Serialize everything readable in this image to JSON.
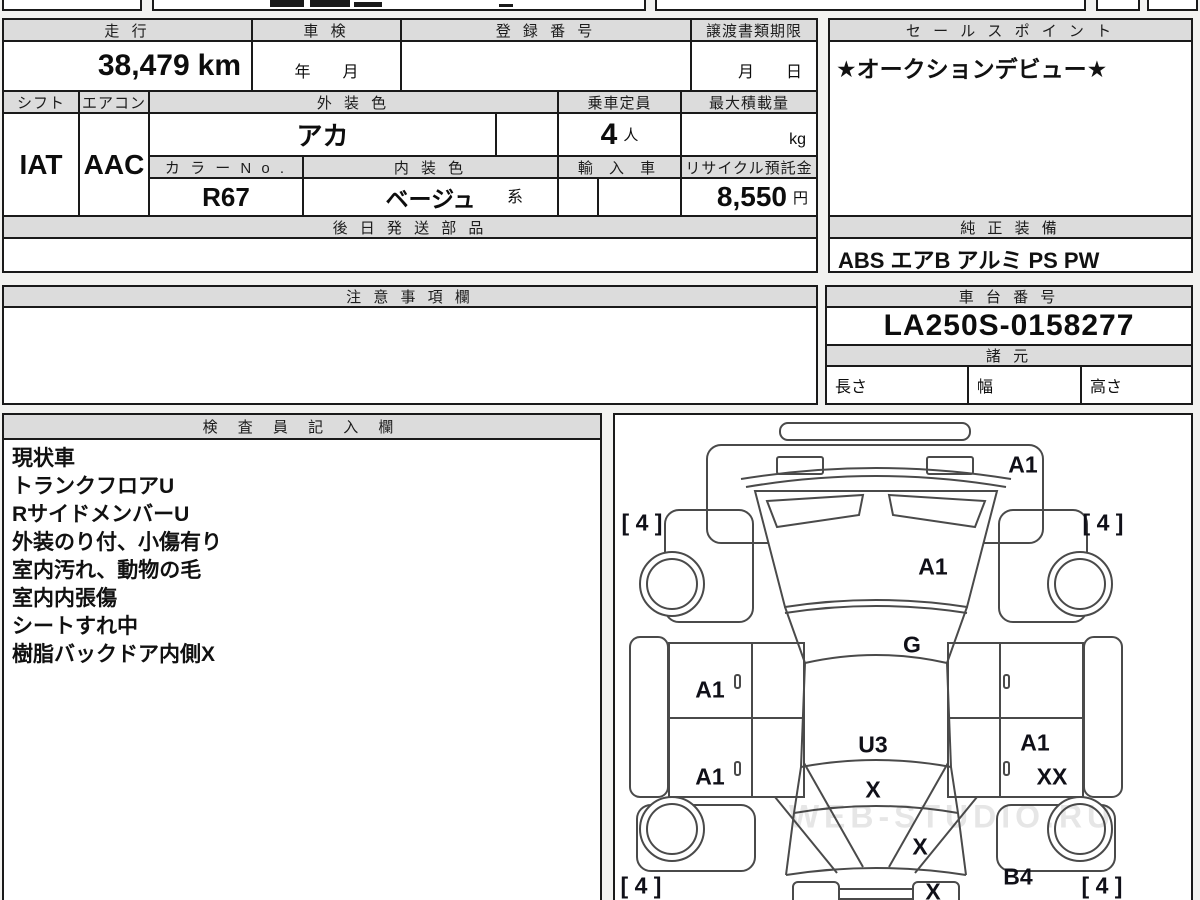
{
  "table": {
    "mileage": {
      "label": "走 行",
      "value": "38,479",
      "unit": "km"
    },
    "inspection": {
      "label": "車 検",
      "value": "年　　月"
    },
    "registration": {
      "label": "登 録 番 号",
      "value": ""
    },
    "transfer_deadline": {
      "label": "譲渡書類期限",
      "value": "月　　日"
    },
    "sales_point": {
      "label": "セ ー ル ス ポ イ ン ト",
      "value": "★オークションデビュー★"
    },
    "shift": {
      "label": "シフト",
      "value": "IAT"
    },
    "aircon": {
      "label": "エアコン",
      "value": "AAC"
    },
    "exterior_color": {
      "label": "外 装 色",
      "value": "アカ"
    },
    "capacity": {
      "label": "乗車定員",
      "value": "4",
      "unit": "人"
    },
    "max_load": {
      "label": "最大積載量",
      "unit": "kg"
    },
    "color_no": {
      "label": "カ ラ ー N o .",
      "value": "R67"
    },
    "interior_color": {
      "label": "内 装 色",
      "value": "ベージュ",
      "suffix": "系"
    },
    "import": {
      "label": "輸 入 車",
      "value": ""
    },
    "recycle_deposit": {
      "label": "リサイクル預託金",
      "value": "8,550",
      "unit": "円"
    },
    "later_parts": {
      "label": "後 日 発 送 部 品",
      "value": ""
    },
    "genuine_equipment": {
      "label": "純 正 装 備",
      "value": "ABS エアB アルミ PS PW"
    }
  },
  "notes": {
    "label": "注 意 事 項 欄",
    "value": ""
  },
  "chassis": {
    "label": "車 台 番 号",
    "value": "LA250S-0158277",
    "spec_label": "諸 元",
    "length_label": "長さ",
    "width_label": "幅",
    "height_label": "高さ"
  },
  "inspector": {
    "label": "検 査 員 記 入 欄",
    "lines": [
      "現状車",
      "トランクフロアU",
      "RサイドメンバーU",
      "外装のり付、小傷有り",
      "室内汚れ、動物の毛",
      "室内内張傷",
      "シートすれ中",
      "樹脂バックドア内側X"
    ]
  },
  "diagram": {
    "watermark": "WEB-STUDIO.RU",
    "labels": [
      {
        "text": "A1",
        "x": 408,
        "y": 50
      },
      {
        "text": "[ 4 ]",
        "x": 27,
        "y": 108
      },
      {
        "text": "[ 4 ]",
        "x": 488,
        "y": 108
      },
      {
        "text": "A1",
        "x": 318,
        "y": 152
      },
      {
        "text": "G",
        "x": 297,
        "y": 230
      },
      {
        "text": "A1",
        "x": 95,
        "y": 275
      },
      {
        "text": "U3",
        "x": 258,
        "y": 330
      },
      {
        "text": "A1",
        "x": 420,
        "y": 328
      },
      {
        "text": "A1",
        "x": 95,
        "y": 362
      },
      {
        "text": "X",
        "x": 258,
        "y": 375
      },
      {
        "text": "XX",
        "x": 437,
        "y": 362
      },
      {
        "text": "X",
        "x": 305,
        "y": 432
      },
      {
        "text": "B4",
        "x": 403,
        "y": 462
      },
      {
        "text": "X",
        "x": 318,
        "y": 477
      },
      {
        "text": "[ 4 ]",
        "x": 26,
        "y": 471
      },
      {
        "text": "[ 4 ]",
        "x": 487,
        "y": 471
      }
    ]
  }
}
